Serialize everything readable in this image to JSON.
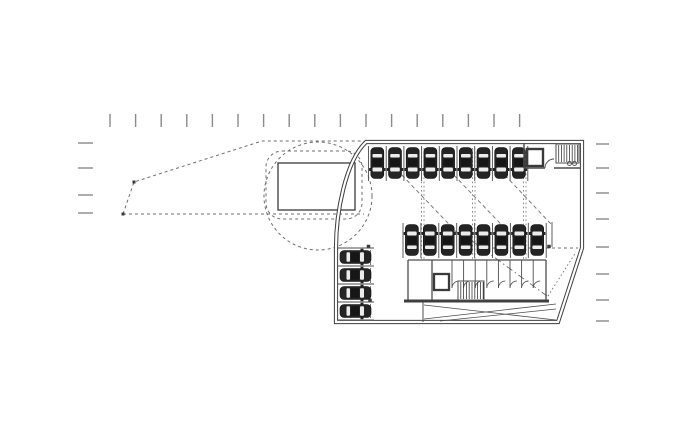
{
  "meta": {
    "canvas_width": 700,
    "canvas_height": 424
  },
  "colors": {
    "background": "#ffffff",
    "ink": "#3a3a3a",
    "thin": "#4d4d4d",
    "wall": "#3f3f3f",
    "dash": "#6f6f6f",
    "tick": "#8a8a8a",
    "car_body": "#242424",
    "car_roof": "#161616",
    "car_window": "#ececec",
    "white": "#ffffff"
  },
  "plan": {
    "layers": [
      {
        "name": "site-ticks-top",
        "shapes": [
          {
            "t": "vticks",
            "x0": 110,
            "dx": 25.6,
            "n": 17,
            "y": 114,
            "len": 13,
            "w": 1.4,
            "c": "tick"
          }
        ]
      },
      {
        "name": "site-ticks-left",
        "shapes": [
          {
            "t": "hticks",
            "ys": [
              143,
              168,
              195,
              213
            ],
            "x": 78,
            "len": 15,
            "w": 1.4,
            "c": "tick"
          }
        ]
      },
      {
        "name": "site-ticks-right",
        "shapes": [
          {
            "t": "hticks",
            "ys": [
              144,
              168,
              193,
              219,
              247,
              274,
              300,
              321
            ],
            "x": 596,
            "len": 13,
            "w": 1.4,
            "c": "tick"
          }
        ]
      },
      {
        "name": "site-boundary-wedge",
        "shapes": [
          {
            "t": "poly",
            "pts": [
              [
                123,
                214
              ],
              [
                134,
                182
              ],
              [
                262,
                141
              ],
              [
                364,
                141
              ]
            ],
            "dash": "3,3",
            "w": 1,
            "c": "dash"
          },
          {
            "t": "line",
            "x1": 123,
            "y1": 214,
            "x2": 364,
            "y2": 214,
            "dash": "3,3",
            "w": 1,
            "c": "dash"
          },
          {
            "t": "squares",
            "pts": [
              [
                123,
                214
              ],
              [
                134,
                182
              ]
            ],
            "s": 3,
            "c": "ink"
          }
        ]
      },
      {
        "name": "turning-circle",
        "shapes": [
          {
            "t": "circle",
            "cx": 318,
            "cy": 196,
            "r": 54,
            "dash": "3,3",
            "w": 1,
            "c": "dash"
          },
          {
            "t": "rect",
            "x": 266,
            "y": 151,
            "wd": 96,
            "ht": 68,
            "rx": 16,
            "dash": "3,3",
            "w": 1,
            "c": "dash"
          },
          {
            "t": "rect",
            "x": 278,
            "y": 163,
            "wd": 77,
            "ht": 47,
            "w": 1.3,
            "c": "ink"
          }
        ]
      },
      {
        "name": "building-shell",
        "shapes": [
          {
            "t": "dwall",
            "d": "M366,142 H582 V248 L558,322 H336 V248 C336,214 345,162 366,142 Z",
            "ow": 4.2,
            "iw": 2.2,
            "c": "wall"
          }
        ]
      },
      {
        "name": "column-grid",
        "shapes": [
          {
            "t": "vlines",
            "xs": [
              421.5,
              424,
              472.5,
              475,
              523.5,
              526
            ],
            "y1": 148,
            "y2": 260,
            "dash": "1.6,2.6",
            "w": 0.8,
            "c": "dash"
          }
        ]
      },
      {
        "name": "floor-markings",
        "shapes": [
          {
            "t": "line",
            "x1": 397,
            "y1": 170,
            "x2": 467,
            "y2": 243,
            "dash": "4,3",
            "w": 0.9,
            "c": "dash"
          },
          {
            "t": "line",
            "x1": 449,
            "y1": 170,
            "x2": 519,
            "y2": 243,
            "dash": "4,3",
            "w": 0.9,
            "c": "dash"
          },
          {
            "t": "line",
            "x1": 500,
            "y1": 170,
            "x2": 551,
            "y2": 224,
            "dash": "4,3",
            "w": 0.9,
            "c": "dash"
          },
          {
            "t": "line",
            "x1": 460,
            "y1": 232,
            "x2": 547,
            "y2": 296,
            "dash": "7,3,1.5,3",
            "w": 0.9,
            "c": "dash"
          },
          {
            "t": "line",
            "x1": 548,
            "y1": 296,
            "x2": 576,
            "y2": 252,
            "dash": "1.5,2.5",
            "w": 0.9,
            "c": "dash"
          },
          {
            "t": "line",
            "x1": 492,
            "y1": 248,
            "x2": 578,
            "y2": 248,
            "dash": "3,3",
            "w": 0.9,
            "c": "dash"
          },
          {
            "t": "line",
            "x1": 370.5,
            "y1": 250,
            "x2": 370.5,
            "y2": 318,
            "dash": "3,3",
            "w": 0.9,
            "c": "dash"
          },
          {
            "t": "squares",
            "pts": [
              [
                549,
                246.5
              ],
              [
                368.5,
                246.5
              ],
              [
                370,
                300.5
              ]
            ],
            "s": 3.5,
            "c": "ink"
          }
        ]
      },
      {
        "name": "parking-row-top",
        "shapes": [
          {
            "t": "vstalls",
            "x0": 368.5,
            "dx": 17.7,
            "n": 10,
            "y": 146,
            "len": 35,
            "w": 0.9,
            "c": "thin"
          },
          {
            "t": "cars",
            "cx0": 377.3,
            "d": 17.7,
            "n": 9,
            "cy": 163,
            "rot": 180
          }
        ]
      },
      {
        "name": "parking-row-mid",
        "shapes": [
          {
            "t": "vstalls",
            "x0": 403,
            "dx": 17.9,
            "n": 9,
            "y": 223,
            "len": 35,
            "w": 0.9,
            "c": "thin"
          },
          {
            "t": "line",
            "x1": 552,
            "y1": 222,
            "x2": 552,
            "y2": 247,
            "w": 0.9,
            "c": "thin"
          },
          {
            "t": "cars",
            "cx0": 411.9,
            "d": 17.9,
            "n": 8,
            "cy": 240,
            "rot": 0
          }
        ]
      },
      {
        "name": "parking-col-left",
        "shapes": [
          {
            "t": "hstalls",
            "y0": 248,
            "dy": 18,
            "n": 5,
            "x": 337,
            "len": 37,
            "w": 0.9,
            "c": "thin"
          },
          {
            "t": "cars",
            "cy0": 257,
            "d": 18,
            "n": 4,
            "cx": 355.5,
            "rot": 90
          }
        ]
      },
      {
        "name": "stair-core",
        "shapes": [
          {
            "t": "line",
            "x1": 524,
            "y1": 143,
            "x2": 524,
            "y2": 168,
            "w": 1.4,
            "c": "thin"
          },
          {
            "t": "line",
            "x1": 524,
            "y1": 168,
            "x2": 545,
            "y2": 168,
            "w": 1.4,
            "c": "thin"
          },
          {
            "t": "line",
            "x1": 554,
            "y1": 168,
            "x2": 580,
            "y2": 168,
            "w": 1.4,
            "c": "thin"
          },
          {
            "t": "rect",
            "x": 556,
            "y": 144,
            "wd": 23,
            "ht": 19,
            "w": 1,
            "c": "thin"
          },
          {
            "t": "hatch",
            "x": 556,
            "y": 144,
            "wd": 23,
            "ht": 19,
            "step": 2.7,
            "w": 0.8,
            "c": "ink"
          },
          {
            "t": "rect",
            "x": 527,
            "y": 149,
            "wd": 16,
            "ht": 17,
            "w": 2.4,
            "c": "ink"
          },
          {
            "t": "path",
            "d": "M545,168 A9,9 0 0 1 554,159",
            "w": 0.9,
            "c": "thin"
          },
          {
            "t": "circle",
            "cx": 569.5,
            "cy": 163.5,
            "r": 2,
            "w": 0.9,
            "c": "thin"
          },
          {
            "t": "circle",
            "cx": 574.5,
            "cy": 163.5,
            "r": 2,
            "w": 0.9,
            "c": "thin"
          }
        ]
      },
      {
        "name": "storage-rooms",
        "shapes": [
          {
            "t": "line",
            "x1": 408,
            "y1": 260,
            "x2": 546,
            "y2": 260,
            "w": 1.3,
            "c": "thin"
          },
          {
            "t": "line",
            "x1": 408,
            "y1": 260,
            "x2": 408,
            "y2": 301,
            "w": 1.3,
            "c": "thin"
          },
          {
            "t": "line",
            "x1": 546,
            "y1": 260,
            "x2": 546,
            "y2": 301,
            "w": 1.3,
            "c": "thin"
          },
          {
            "t": "line",
            "x1": 404,
            "y1": 301,
            "x2": 549,
            "y2": 301,
            "w": 3,
            "c": "wall"
          },
          {
            "t": "line",
            "x1": 432,
            "y1": 260,
            "x2": 432,
            "y2": 300,
            "w": 1.3,
            "c": "thin"
          },
          {
            "t": "rect",
            "x": 434,
            "y": 274,
            "wd": 15,
            "ht": 16,
            "w": 2.3,
            "c": "ink"
          },
          {
            "t": "vstalls",
            "x0": 452,
            "dx": 11.6,
            "n": 8,
            "y": 260,
            "len": 21,
            "w": 0.9,
            "c": "thin"
          },
          {
            "t": "doorarcs",
            "x0": 452,
            "dx": 11.6,
            "n": 8,
            "y": 281,
            "r": 7,
            "w": 0.8,
            "c": "thin"
          },
          {
            "t": "rect",
            "x": 458,
            "y": 281,
            "wd": 26,
            "ht": 19,
            "w": 1,
            "c": "thin"
          },
          {
            "t": "hatch",
            "x": 458,
            "y": 281,
            "wd": 26,
            "ht": 19,
            "step": 2.8,
            "w": 0.8,
            "c": "ink"
          }
        ]
      },
      {
        "name": "ramp",
        "shapes": [
          {
            "t": "line",
            "x1": 423,
            "y1": 302,
            "x2": 423,
            "y2": 322,
            "w": 1,
            "c": "thin"
          },
          {
            "t": "line",
            "x1": 424,
            "y1": 305,
            "x2": 556,
            "y2": 320,
            "w": 0.8,
            "c": "thin"
          },
          {
            "t": "line",
            "x1": 424,
            "y1": 319,
            "x2": 556,
            "y2": 304,
            "w": 0.8,
            "c": "thin"
          },
          {
            "t": "line",
            "x1": 440,
            "y1": 321,
            "x2": 556,
            "y2": 309,
            "w": 0.8,
            "c": "thin"
          }
        ]
      }
    ]
  }
}
